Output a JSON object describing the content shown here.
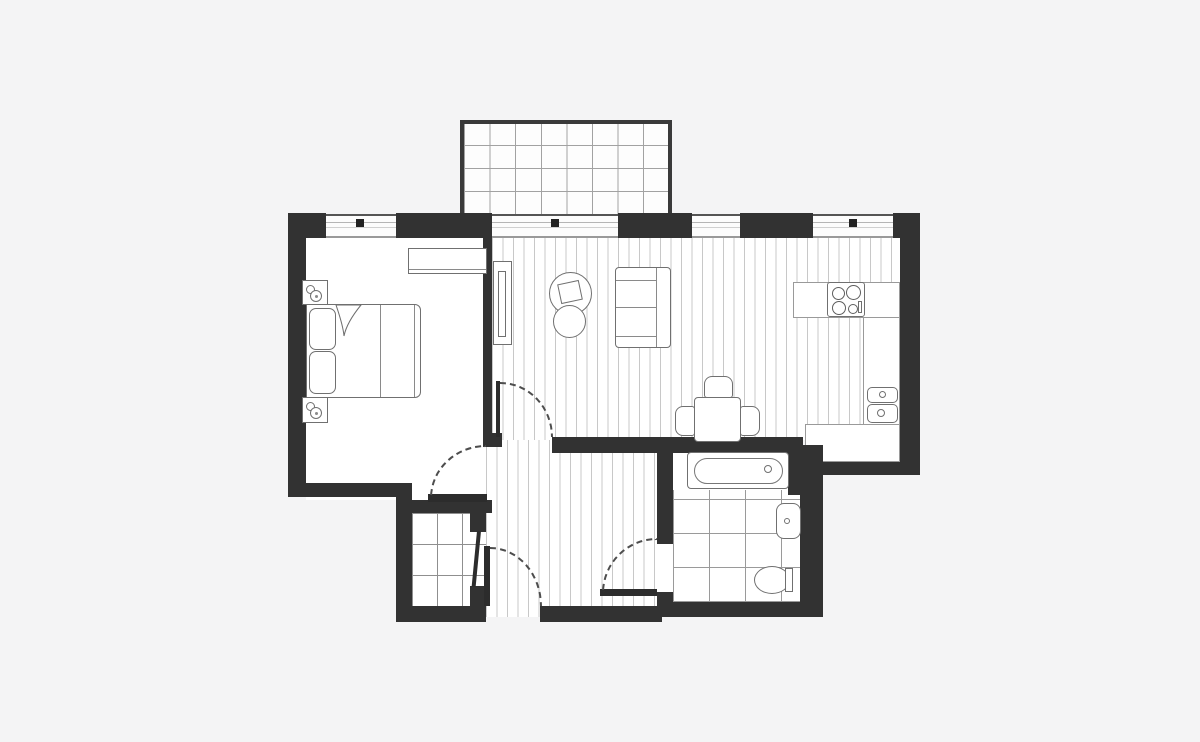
{
  "meta": {
    "type": "apartment-floor-plan",
    "canvas": {
      "width": 1200,
      "height": 742
    },
    "visible_text": []
  },
  "palette": {
    "bg": "#f4f4f5",
    "wall": "#323232",
    "floor": "#ffffff",
    "plank": "#c8c8c8",
    "tile_line": "#8f8f8f",
    "outline": "#707070",
    "door_arc": "#4d4d4d"
  },
  "rooms": [
    {
      "id": "balcony",
      "floor": "paved-grid",
      "openings": [
        "glazed-door-with-handle",
        "window"
      ]
    },
    {
      "id": "bedroom",
      "floor": "plain",
      "windows": [
        "window-with-handle"
      ],
      "furniture": [
        "double-bed",
        "pillow",
        "pillow",
        "duvet-fold",
        "nightstand-with-lamp",
        "nightstand-with-lamp",
        "wardrobe"
      ]
    },
    {
      "id": "living-dining-kitchen",
      "floor": "timber-planks",
      "windows": [
        "window-small",
        "window-with-handle"
      ],
      "furniture": [
        "media-unit",
        "coffee-table-large",
        "coffee-table-small",
        "two-seat-sofa",
        "dining-table",
        "dining-chair",
        "dining-chair",
        "dining-chair",
        "l-shaped-kitchen-counter",
        "hob-four-rings",
        "double-sink"
      ]
    },
    {
      "id": "hallway",
      "floor": "timber-planks",
      "doors": [
        "entrance-door",
        "bedroom-door",
        "living-room-door",
        "bathroom-door",
        "storage-door"
      ]
    },
    {
      "id": "storage-closet",
      "floor": "tiled"
    },
    {
      "id": "bathroom",
      "floor": "tiled",
      "fixtures": [
        "bathtub",
        "washbasin",
        "toilet"
      ]
    }
  ]
}
